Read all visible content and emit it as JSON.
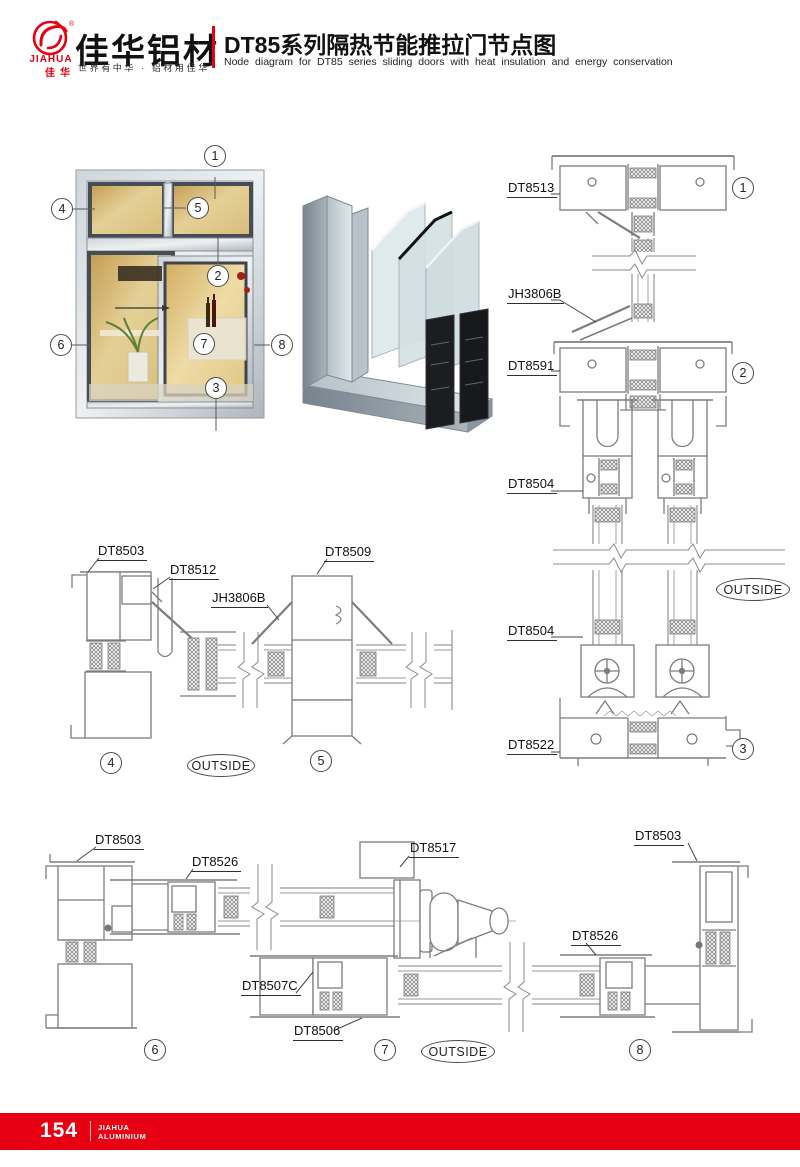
{
  "header": {
    "accent_color": "#e60012",
    "logo": {
      "brand_en": "JIAHUA",
      "brand_cn": "佳华",
      "reg_mark": "®"
    },
    "company_cn": "佳华铝材",
    "tagline": "世界有中华 · 铝材用佳华",
    "title_cn": "DT85系列隔热节能推拉门节点图",
    "title_en": "Node diagram for DT85 series sliding doors with heat insulation and energy conservation"
  },
  "overview": {
    "callouts": [
      "1",
      "2",
      "3",
      "4",
      "5",
      "6",
      "7",
      "8"
    ]
  },
  "sections": {
    "vertical": {
      "labels": [
        "DT8513",
        "JH3806B",
        "DT8591",
        "DT8504",
        "DT8504",
        "DT8522"
      ],
      "markers": [
        "1",
        "2",
        "3"
      ],
      "outside": "OUTSIDE"
    },
    "plan_top": {
      "labels": [
        "DT8503",
        "DT8512",
        "JH3806B",
        "DT8509"
      ],
      "markers": [
        "4",
        "5"
      ],
      "outside": "OUTSIDE"
    },
    "plan_bottom": {
      "labels": [
        "DT8503",
        "DT8526",
        "DT8517",
        "DT8503",
        "DT8526",
        "DT8507C",
        "DT8506"
      ],
      "markers": [
        "6",
        "7",
        "8"
      ],
      "outside": "OUTSIDE"
    }
  },
  "footer": {
    "bg": "#e60012",
    "page_number": "154",
    "brand_line1": "JIAHUA",
    "brand_line2": "ALUMINIUM"
  }
}
